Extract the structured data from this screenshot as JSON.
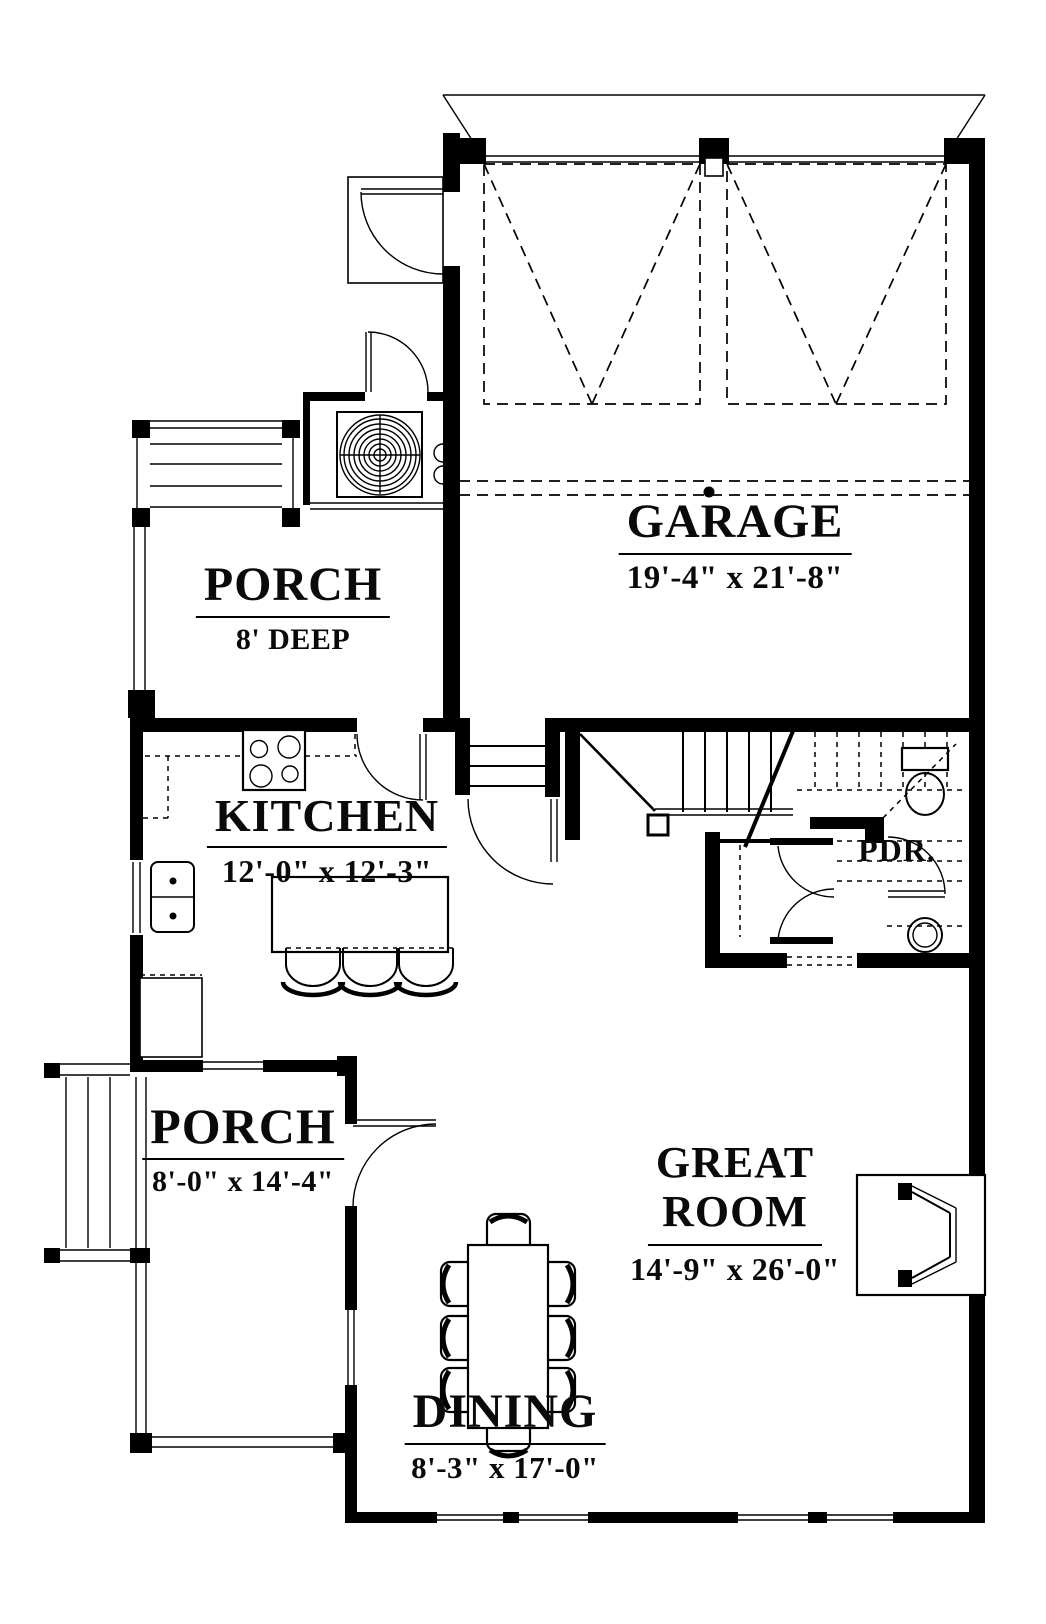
{
  "rooms": {
    "garage": {
      "name": "GARAGE",
      "dims": "19'-4\" x 21'-8\""
    },
    "porch_upper": {
      "name": "PORCH",
      "dims": "8' DEEP"
    },
    "kitchen": {
      "name": "KITCHEN",
      "dims": "12'-0\" x 12'-3\""
    },
    "powder": {
      "name": "PDR."
    },
    "great_room": {
      "line1": "GREAT",
      "line2": "ROOM",
      "dims": "14'-9\" x 26'-0\""
    },
    "porch_lower": {
      "name": "PORCH",
      "dims": "8'-0\" x 14'-4\""
    },
    "dining": {
      "name": "DINING",
      "dims": "8'-3\" x 17'-0\""
    }
  },
  "colors": {
    "line": "#000000",
    "background": "#ffffff"
  }
}
